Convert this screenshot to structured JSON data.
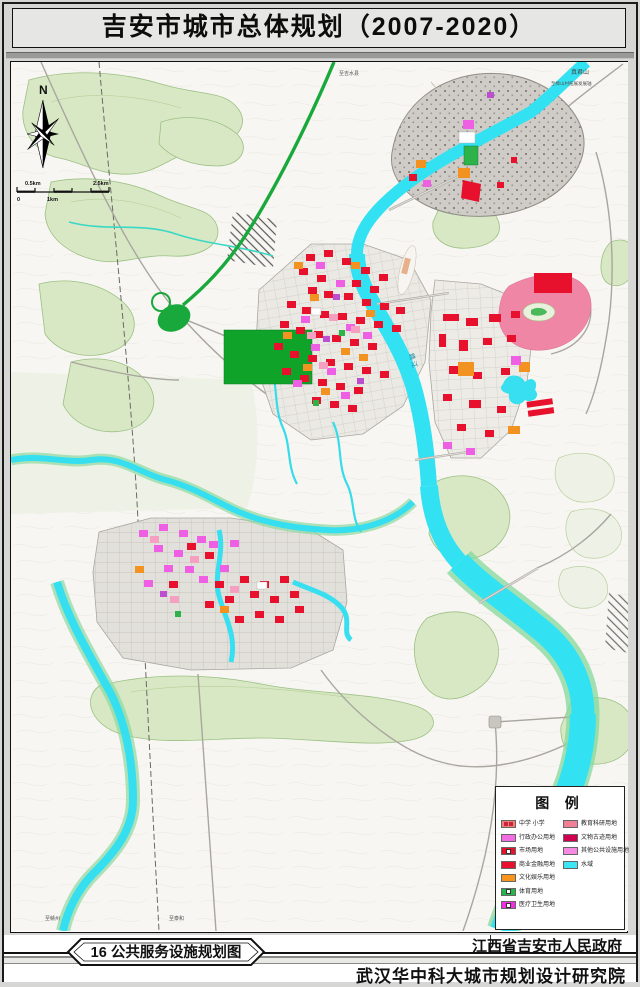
{
  "title": "吉安市城市总体规划（2007-2020）",
  "compass": {
    "north_label": "N"
  },
  "scale_bar": {
    "top_left_label": "0.5km",
    "top_right_label": "2.5km",
    "bottom_left_label": "0",
    "bottom_mid_label": "1km"
  },
  "map_labels": {
    "mountain_ne": "真君山",
    "ne_axis": "至樟山村拓展发展轴",
    "to_jishui": "至吉水县",
    "river": "赣 江",
    "to_ganzhou": "至赣州",
    "to_taihe": "至泰和"
  },
  "legend": {
    "title": "图 例",
    "left_items": [
      {
        "label": "中学 小学",
        "color": "#f08070"
      },
      {
        "label": "行政办公用地",
        "color": "#f26ce2"
      },
      {
        "label": "市场用地",
        "color": "#e8112d"
      },
      {
        "label": "商业金融用地",
        "color": "#e8112d"
      },
      {
        "label": "文化娱乐用地",
        "color": "#f7941e"
      },
      {
        "label": "体育用地",
        "color": "#28b44c"
      },
      {
        "label": "医疗卫生用地",
        "color": "#f030e0"
      }
    ],
    "right_items": [
      {
        "label": "教育科研用地",
        "color": "#f08098"
      },
      {
        "label": "文物古迹用地",
        "color": "#cf0050"
      },
      {
        "label": "其他公共设施用地",
        "color": "#f78ae0"
      },
      {
        "label": "水域",
        "color": "#3ce4f4"
      }
    ]
  },
  "footer": {
    "figure_badge": "16  公共服务设施规划图",
    "government": "江西省吉安市人民政府",
    "institute": "武汉华中科大城市规划设计研究院"
  },
  "colors": {
    "water": "#33e2f2",
    "vegetation": "#d8e8c4",
    "expressway_green": "#19a83c",
    "commercial_red": "#e8112d"
  }
}
